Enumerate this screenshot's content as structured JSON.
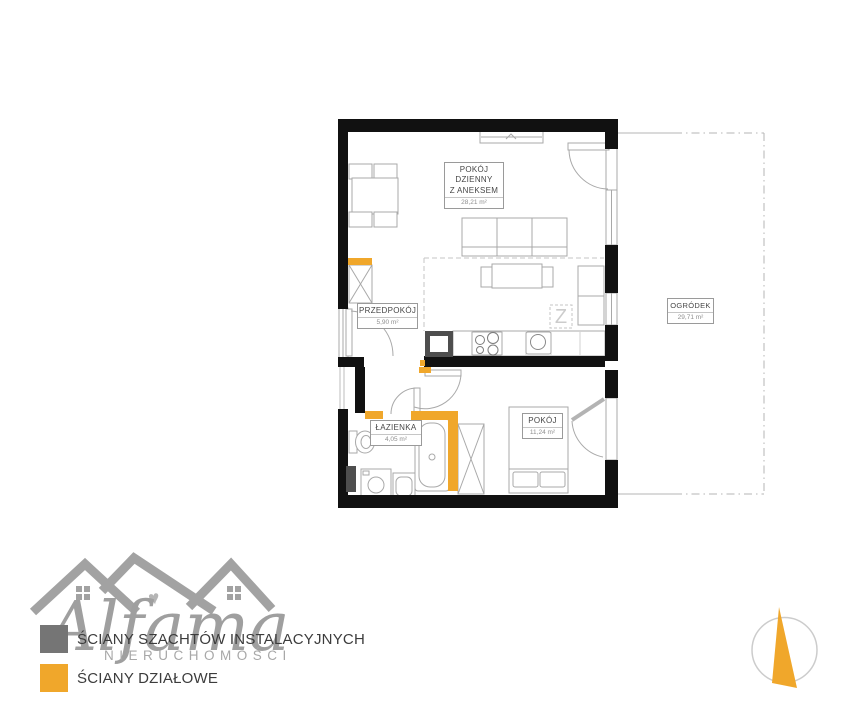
{
  "floor_plan": {
    "rooms": {
      "living": {
        "name_line1": "POKÓJ",
        "name_line2": "DZIENNY",
        "name_line3": "Z ANEKSEM",
        "area": "28,21 m²"
      },
      "hallway": {
        "name": "PRZEDPOKÓJ",
        "area": "5,90 m²"
      },
      "bathroom": {
        "name": "ŁAZIENKA",
        "area": "4,05 m²"
      },
      "bedroom": {
        "name": "POKÓJ",
        "area": "11,24 m²"
      },
      "garden": {
        "name": "OGRÓDEK",
        "area": "29,71 m²"
      }
    },
    "markings": {
      "dishwasher": "Z"
    }
  },
  "legend": {
    "items": [
      {
        "label": "ŚCIANY SZACHTÓW INSTALACYJNYCH",
        "color": "#757575"
      },
      {
        "label": "ŚCIANY DZIAŁOWE",
        "color": "#F0A72B"
      }
    ]
  },
  "branding": {
    "logo_text": "Alfama",
    "logo_subtitle": "NIERUCHOMOŚCI"
  },
  "colors": {
    "structural_wall": "#111111",
    "shaft_wall": "#4e4e4e",
    "partition_wall": "#F0A72B",
    "compass_needle": "#F0A72B"
  }
}
